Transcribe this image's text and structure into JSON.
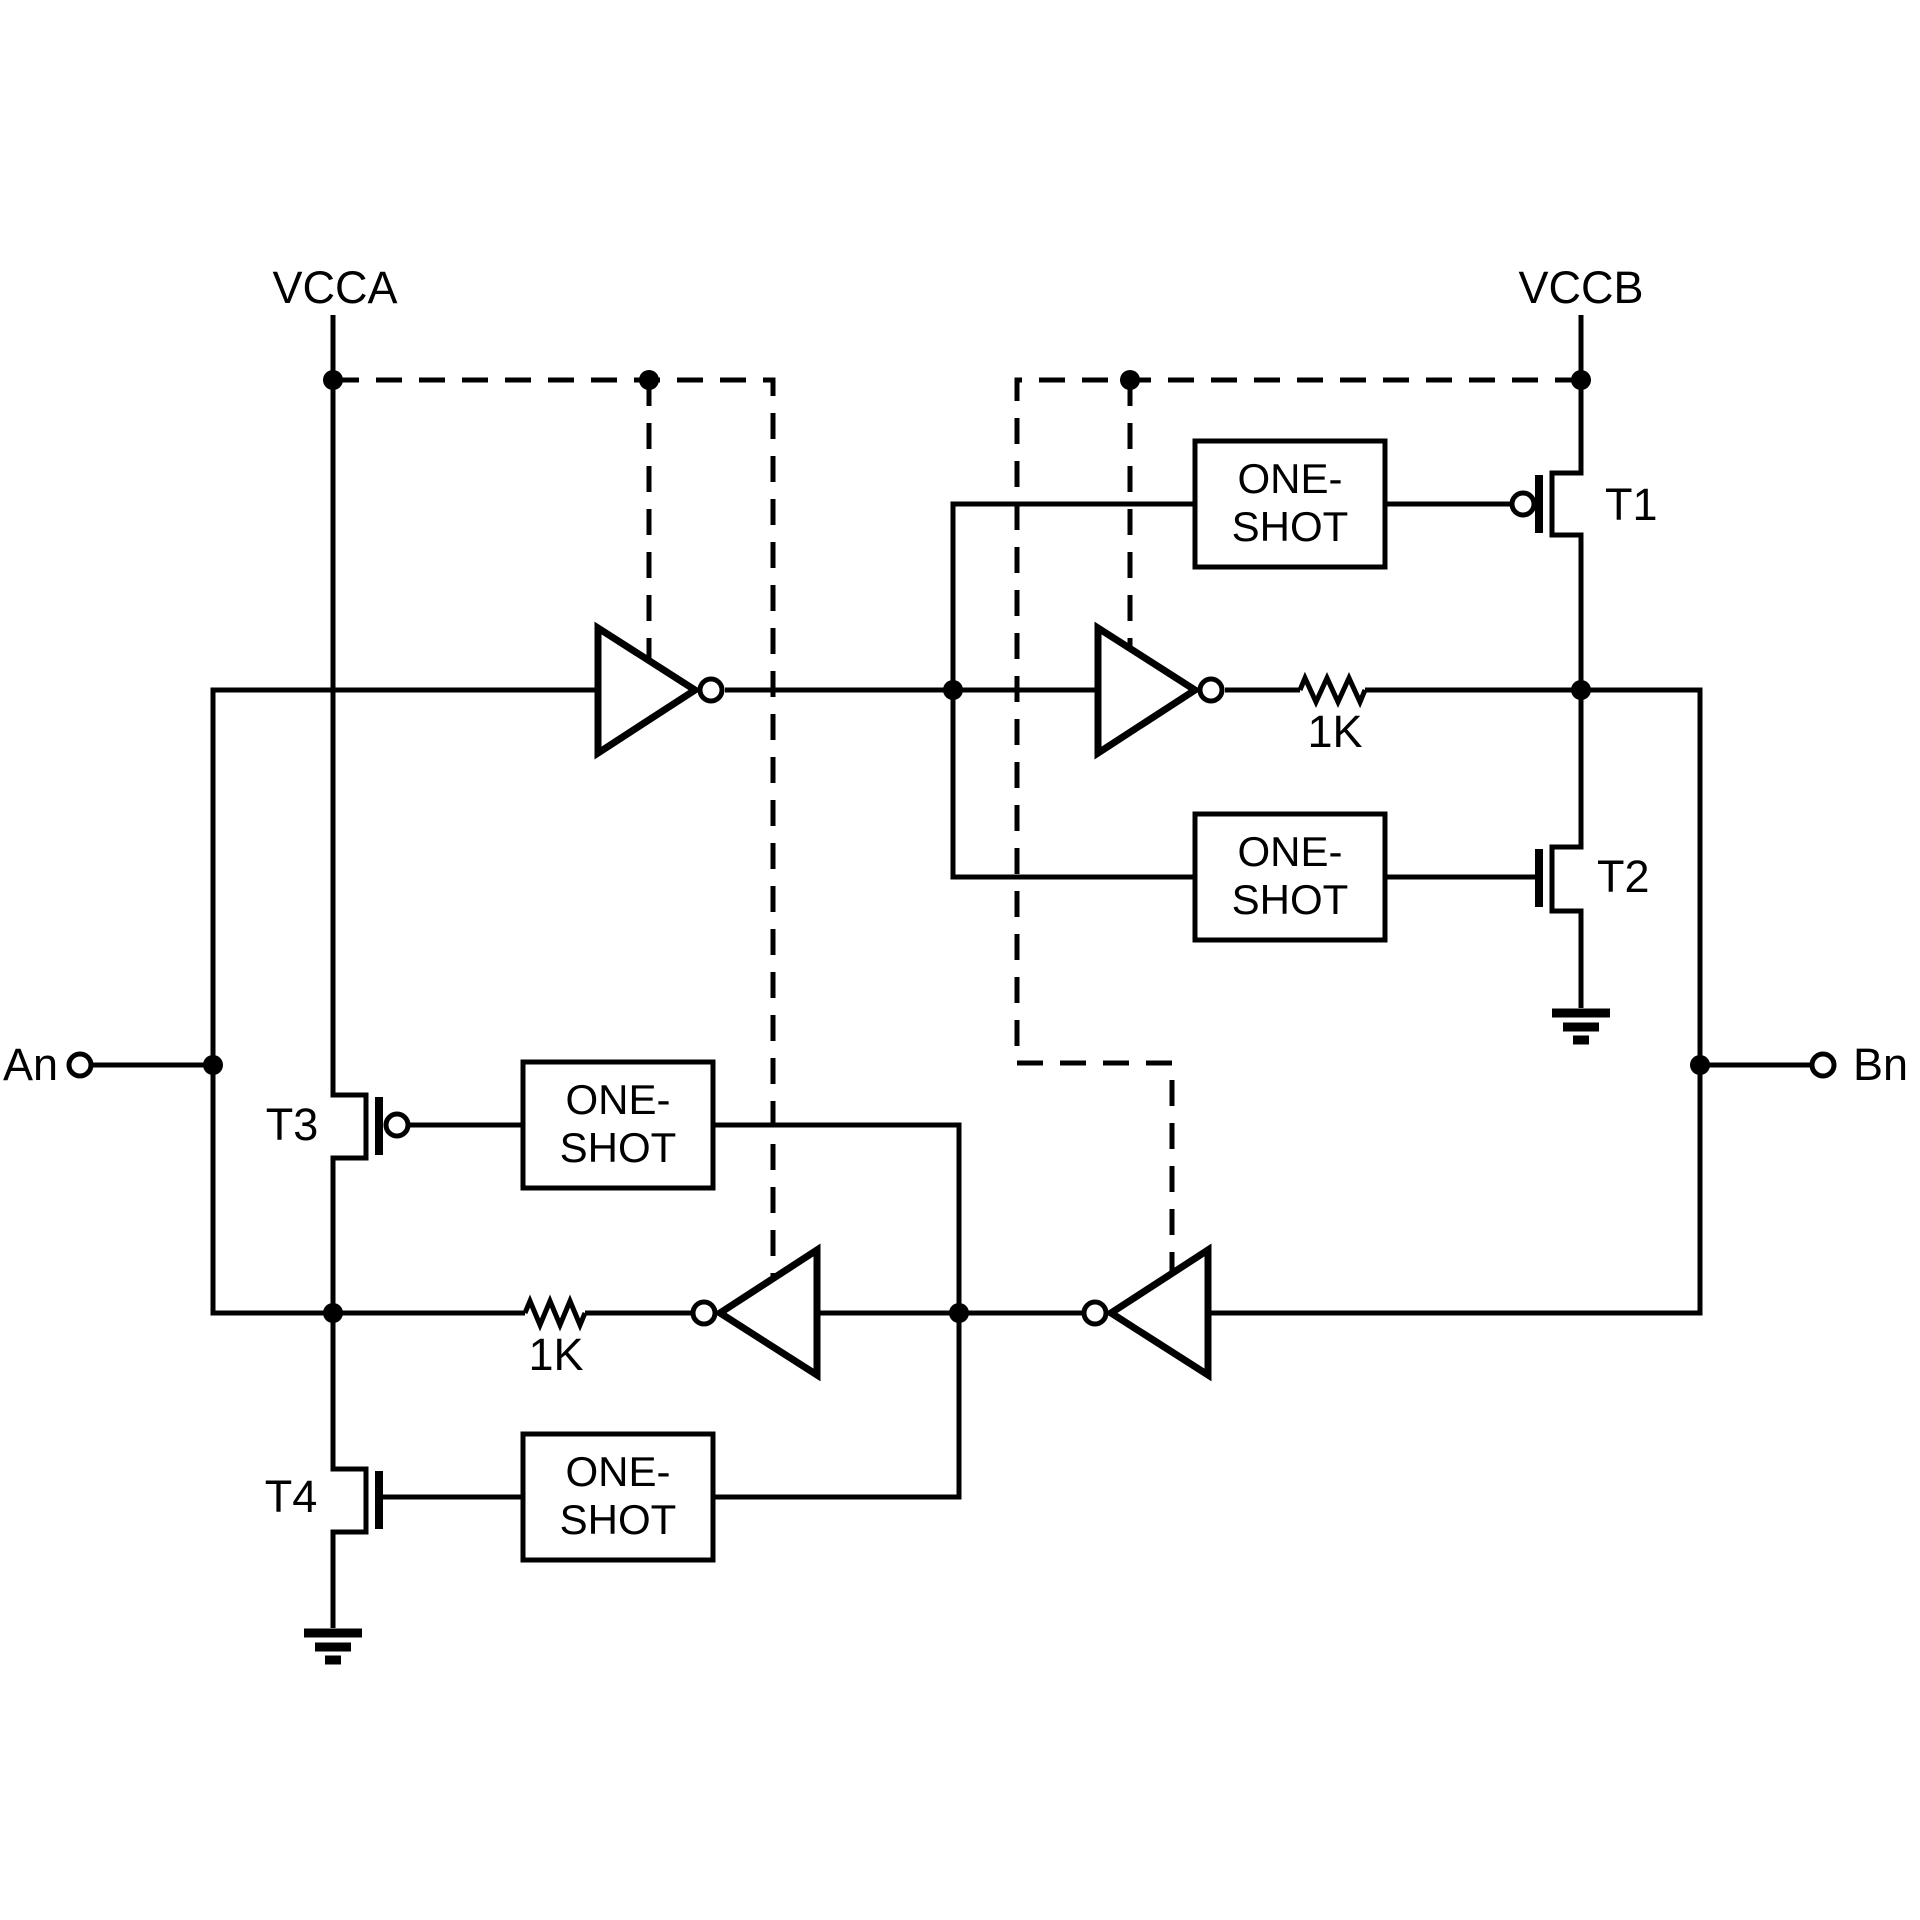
{
  "palette": {
    "ink": "#000000",
    "paper": "#ffffff"
  },
  "labels": {
    "supply_a": "VCCA",
    "supply_b": "VCCB",
    "port_a": "An",
    "port_b": "Bn",
    "t1": "T1",
    "t2": "T2",
    "t3": "T3",
    "t4": "T4",
    "resistor_top": "1K",
    "resistor_bottom": "1K",
    "one_shot_line1": "ONE-",
    "one_shot_line2": "SHOT"
  }
}
